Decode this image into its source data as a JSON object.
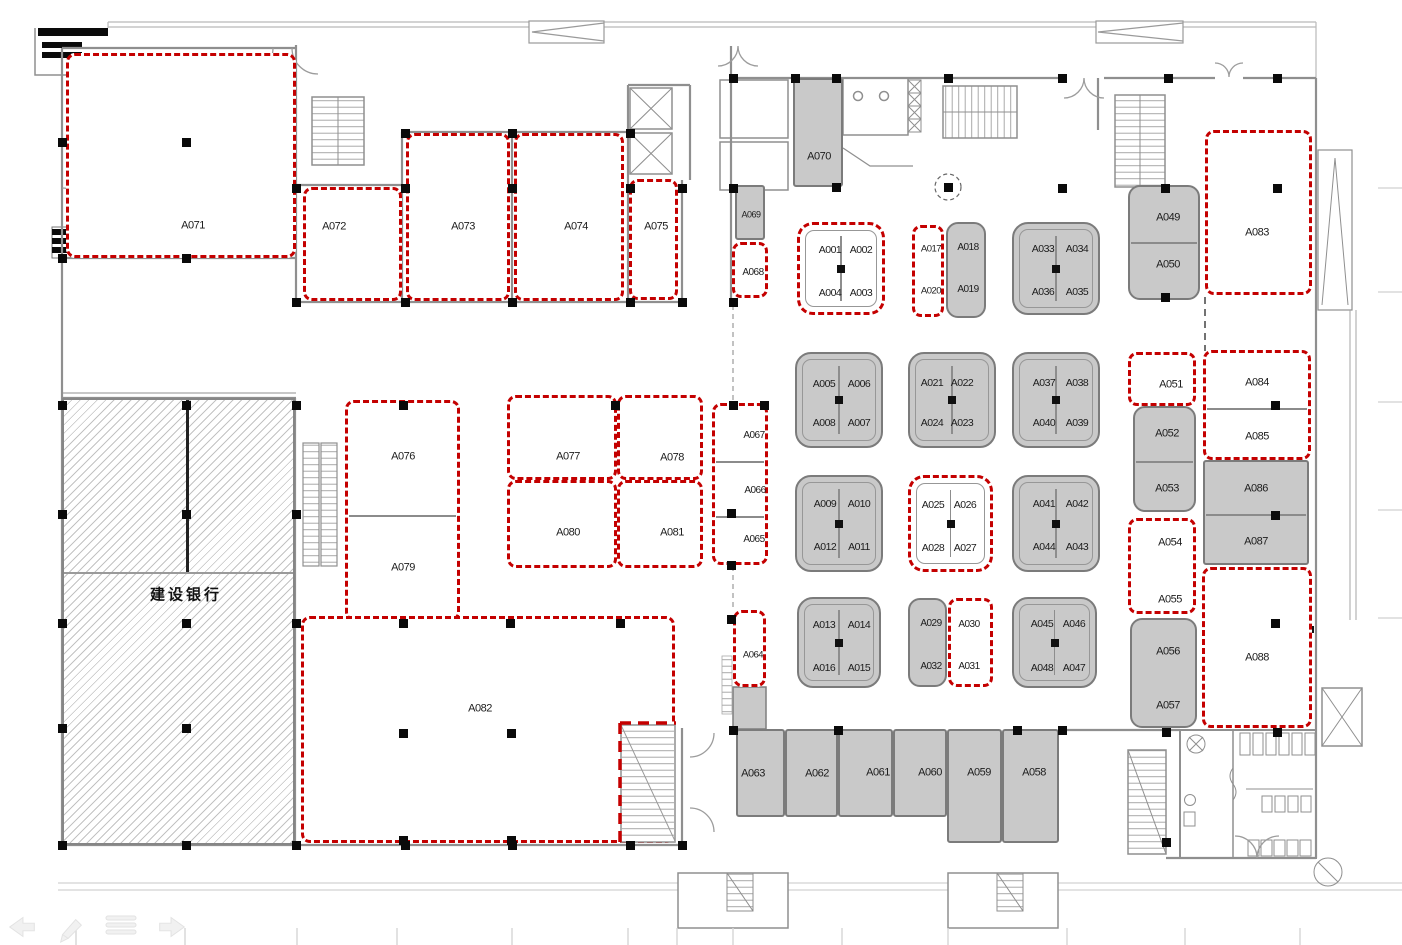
{
  "plan_title": "Mall floor plan with leasing unit numbers",
  "colors": {
    "accent_red": "#c40000",
    "unit_gray": "#c9c9c9",
    "wall_gray": "#8f8f8f",
    "hatch_gray": "#919191"
  },
  "bank": {
    "label": "建设银行"
  },
  "ghost_toolbar": {
    "icons": [
      {
        "name": "back-arrow-icon"
      },
      {
        "name": "pencil-icon"
      },
      {
        "name": "list-icon"
      },
      {
        "name": "forward-arrow-icon"
      }
    ]
  },
  "units": [
    {
      "s": "red",
      "x": 66,
      "y": 53,
      "w": 230,
      "h": 205,
      "l": [
        {
          "t": "A071",
          "cx": 190,
          "cy": 223
        }
      ]
    },
    {
      "s": "red",
      "x": 303,
      "y": 187,
      "w": 99,
      "h": 114,
      "l": [
        {
          "t": "A072",
          "cx": 331,
          "cy": 224
        }
      ]
    },
    {
      "s": "red",
      "x": 406,
      "y": 133,
      "w": 104,
      "h": 168,
      "l": [
        {
          "t": "A073",
          "cx": 460,
          "cy": 224
        }
      ]
    },
    {
      "s": "red",
      "x": 514,
      "y": 133,
      "w": 110,
      "h": 168,
      "l": [
        {
          "t": "A074",
          "cx": 573,
          "cy": 224
        }
      ]
    },
    {
      "s": "red",
      "x": 629,
      "y": 179,
      "w": 49,
      "h": 121,
      "l": [
        {
          "t": "A075",
          "cx": 653,
          "cy": 224
        }
      ]
    },
    {
      "s": "gray",
      "x": 793,
      "y": 78,
      "w": 50,
      "h": 109,
      "l": [
        {
          "t": "A070",
          "cx": 817,
          "cy": 155
        }
      ]
    },
    {
      "s": "gray",
      "x": 735,
      "y": 185,
      "w": 30,
      "h": 55,
      "fs": 9,
      "l": [
        {
          "t": "A069",
          "cx": 749,
          "cy": 213
        }
      ]
    },
    {
      "s": "red",
      "x": 732,
      "y": 242,
      "w": 36,
      "h": 56,
      "fs": 10,
      "l": [
        {
          "t": "A068",
          "cx": 750,
          "cy": 270
        }
      ]
    },
    {
      "s": "kioskred",
      "x": 797,
      "y": 222,
      "w": 88,
      "h": 93,
      "l": [
        {
          "t": "A001",
          "cx": 827,
          "cy": 247
        },
        {
          "t": "A002",
          "cx": 858,
          "cy": 247
        },
        {
          "t": "A004",
          "cx": 827,
          "cy": 290
        },
        {
          "t": "A003",
          "cx": 858,
          "cy": 290
        }
      ]
    },
    {
      "s": "red",
      "x": 912,
      "y": 225,
      "w": 32,
      "h": 92,
      "fs": 9.5,
      "l": [
        {
          "t": "A017",
          "cx": 928,
          "cy": 246
        },
        {
          "t": "A020",
          "cx": 928,
          "cy": 288
        }
      ]
    },
    {
      "s": "grayround",
      "x": 946,
      "y": 222,
      "w": 40,
      "h": 96,
      "fs": 10,
      "l": [
        {
          "t": "A018",
          "cx": 966,
          "cy": 246
        },
        {
          "t": "A019",
          "cx": 966,
          "cy": 288
        }
      ]
    },
    {
      "s": "kioskgray",
      "x": 1012,
      "y": 222,
      "w": 88,
      "h": 93,
      "l": [
        {
          "t": "A033",
          "cx": 1041,
          "cy": 247
        },
        {
          "t": "A034",
          "cx": 1075,
          "cy": 247
        },
        {
          "t": "A036",
          "cx": 1041,
          "cy": 290
        },
        {
          "t": "A035",
          "cx": 1075,
          "cy": 290
        }
      ]
    },
    {
      "s": "grayround",
      "x": 1128,
      "y": 185,
      "w": 72,
      "h": 115,
      "d": [
        240
      ],
      "l": [
        {
          "t": "A049",
          "cx": 1166,
          "cy": 216
        },
        {
          "t": "A050",
          "cx": 1166,
          "cy": 263
        }
      ]
    },
    {
      "s": "red",
      "x": 1205,
      "y": 130,
      "w": 107,
      "h": 165,
      "l": [
        {
          "t": "A083",
          "cx": 1254,
          "cy": 230
        }
      ]
    },
    {
      "s": "kioskgray",
      "x": 795,
      "y": 352,
      "w": 88,
      "h": 96,
      "l": [
        {
          "t": "A005",
          "cx": 822,
          "cy": 382
        },
        {
          "t": "A006",
          "cx": 857,
          "cy": 382
        },
        {
          "t": "A008",
          "cx": 822,
          "cy": 421
        },
        {
          "t": "A007",
          "cx": 857,
          "cy": 421
        }
      ]
    },
    {
      "s": "kioskgray",
      "x": 908,
      "y": 352,
      "w": 88,
      "h": 96,
      "l": [
        {
          "t": "A021",
          "cx": 930,
          "cy": 381
        },
        {
          "t": "A022",
          "cx": 960,
          "cy": 381
        },
        {
          "t": "A024",
          "cx": 930,
          "cy": 421
        },
        {
          "t": "A023",
          "cx": 960,
          "cy": 421
        }
      ]
    },
    {
      "s": "kioskgray",
      "x": 1012,
      "y": 352,
      "w": 88,
      "h": 96,
      "l": [
        {
          "t": "A037",
          "cx": 1042,
          "cy": 381
        },
        {
          "t": "A038",
          "cx": 1075,
          "cy": 381
        },
        {
          "t": "A040",
          "cx": 1042,
          "cy": 421
        },
        {
          "t": "A039",
          "cx": 1075,
          "cy": 421
        }
      ]
    },
    {
      "s": "kioskgray",
      "x": 795,
      "y": 475,
      "w": 88,
      "h": 97,
      "l": [
        {
          "t": "A009",
          "cx": 823,
          "cy": 502
        },
        {
          "t": "A010",
          "cx": 857,
          "cy": 502
        },
        {
          "t": "A012",
          "cx": 823,
          "cy": 545
        },
        {
          "t": "A011",
          "cx": 857,
          "cy": 545
        }
      ]
    },
    {
      "s": "kioskred",
      "x": 908,
      "y": 475,
      "w": 85,
      "h": 97,
      "l": [
        {
          "t": "A025",
          "cx": 930,
          "cy": 502
        },
        {
          "t": "A026",
          "cx": 962,
          "cy": 502
        },
        {
          "t": "A028",
          "cx": 930,
          "cy": 545
        },
        {
          "t": "A027",
          "cx": 962,
          "cy": 545
        }
      ]
    },
    {
      "s": "kioskgray",
      "x": 1012,
      "y": 475,
      "w": 88,
      "h": 97,
      "l": [
        {
          "t": "A041",
          "cx": 1042,
          "cy": 502
        },
        {
          "t": "A042",
          "cx": 1075,
          "cy": 502
        },
        {
          "t": "A044",
          "cx": 1042,
          "cy": 545
        },
        {
          "t": "A043",
          "cx": 1075,
          "cy": 545
        }
      ]
    },
    {
      "s": "kioskgray",
      "x": 797,
      "y": 597,
      "w": 84,
      "h": 91,
      "l": [
        {
          "t": "A013",
          "cx": 822,
          "cy": 623
        },
        {
          "t": "A014",
          "cx": 857,
          "cy": 623
        },
        {
          "t": "A016",
          "cx": 822,
          "cy": 666
        },
        {
          "t": "A015",
          "cx": 857,
          "cy": 666
        }
      ]
    },
    {
      "s": "grayround",
      "x": 908,
      "y": 598,
      "w": 39,
      "h": 89,
      "fs": 10,
      "l": [
        {
          "t": "A029",
          "cx": 929,
          "cy": 622
        },
        {
          "t": "A032",
          "cx": 929,
          "cy": 665
        }
      ]
    },
    {
      "s": "red",
      "x": 948,
      "y": 598,
      "w": 45,
      "h": 89,
      "fs": 10,
      "l": [
        {
          "t": "A030",
          "cx": 966,
          "cy": 622
        },
        {
          "t": "A031",
          "cx": 966,
          "cy": 664
        }
      ]
    },
    {
      "s": "kioskgray",
      "x": 1012,
      "y": 597,
      "w": 85,
      "h": 91,
      "l": [
        {
          "t": "A045",
          "cx": 1040,
          "cy": 622
        },
        {
          "t": "A046",
          "cx": 1072,
          "cy": 622
        },
        {
          "t": "A048",
          "cx": 1040,
          "cy": 666
        },
        {
          "t": "A047",
          "cx": 1072,
          "cy": 666
        }
      ]
    },
    {
      "s": "red",
      "x": 1128,
      "y": 352,
      "w": 68,
      "h": 54,
      "l": [
        {
          "t": "A051",
          "cx": 1168,
          "cy": 382
        }
      ]
    },
    {
      "s": "red",
      "x": 1203,
      "y": 350,
      "w": 108,
      "h": 110,
      "d": [
        405
      ],
      "l": [
        {
          "t": "A084",
          "cx": 1254,
          "cy": 380
        },
        {
          "t": "A085",
          "cx": 1254,
          "cy": 434
        }
      ]
    },
    {
      "s": "grayround",
      "x": 1133,
      "y": 406,
      "w": 63,
      "h": 106,
      "d": [
        459
      ],
      "l": [
        {
          "t": "A052",
          "cx": 1165,
          "cy": 432
        },
        {
          "t": "A053",
          "cx": 1165,
          "cy": 487
        }
      ]
    },
    {
      "s": "gray",
      "x": 1203,
      "y": 460,
      "w": 106,
      "h": 105,
      "d": [
        512
      ],
      "l": [
        {
          "t": "A086",
          "cx": 1254,
          "cy": 487
        },
        {
          "t": "A087",
          "cx": 1254,
          "cy": 540
        }
      ]
    },
    {
      "s": "red",
      "x": 1128,
      "y": 518,
      "w": 68,
      "h": 96,
      "l": [
        {
          "t": "A054",
          "cx": 1167,
          "cy": 540
        },
        {
          "t": "A055",
          "cx": 1167,
          "cy": 597
        }
      ]
    },
    {
      "s": "grayround",
      "x": 1130,
      "y": 618,
      "w": 67,
      "h": 110,
      "l": [
        {
          "t": "A056",
          "cx": 1166,
          "cy": 650
        },
        {
          "t": "A057",
          "cx": 1166,
          "cy": 704
        }
      ]
    },
    {
      "s": "red",
      "x": 1202,
      "y": 567,
      "w": 110,
      "h": 161,
      "l": [
        {
          "t": "A088",
          "cx": 1254,
          "cy": 655
        }
      ]
    },
    {
      "s": "red",
      "x": 712,
      "y": 403,
      "w": 56,
      "h": 162,
      "d": [
        458,
        513
      ],
      "fs": 10,
      "l": [
        {
          "t": "A067",
          "cx": 751,
          "cy": 433
        },
        {
          "t": "A066",
          "cx": 752,
          "cy": 488
        },
        {
          "t": "A065",
          "cx": 751,
          "cy": 537
        }
      ]
    },
    {
      "s": "red",
      "x": 733,
      "y": 610,
      "w": 33,
      "h": 77,
      "fs": 9.5,
      "l": [
        {
          "t": "A064",
          "cx": 750,
          "cy": 652
        }
      ]
    },
    {
      "s": "red",
      "x": 345,
      "y": 400,
      "w": 115,
      "h": 221,
      "d": [
        512
      ],
      "l": [
        {
          "t": "A076",
          "cx": 400,
          "cy": 454
        },
        {
          "t": "A079",
          "cx": 400,
          "cy": 565
        }
      ]
    },
    {
      "s": "red",
      "x": 507,
      "y": 395,
      "w": 110,
      "h": 85,
      "l": [
        {
          "t": "A077",
          "cx": 565,
          "cy": 454
        }
      ]
    },
    {
      "s": "red",
      "x": 617,
      "y": 395,
      "w": 86,
      "h": 85,
      "l": [
        {
          "t": "A078",
          "cx": 669,
          "cy": 455
        }
      ]
    },
    {
      "s": "red",
      "x": 507,
      "y": 480,
      "w": 110,
      "h": 88,
      "l": [
        {
          "t": "A080",
          "cx": 565,
          "cy": 530
        }
      ]
    },
    {
      "s": "red",
      "x": 617,
      "y": 480,
      "w": 86,
      "h": 88,
      "l": [
        {
          "t": "A081",
          "cx": 669,
          "cy": 530
        }
      ]
    },
    {
      "s": "red",
      "x": 301,
      "y": 616,
      "w": 374,
      "h": 227,
      "l": [
        {
          "t": "A082",
          "cx": 477,
          "cy": 706
        }
      ]
    },
    {
      "s": "gray",
      "x": 736,
      "y": 729,
      "w": 49,
      "h": 88,
      "l": [
        {
          "t": "A063",
          "cx": 751,
          "cy": 772
        }
      ]
    },
    {
      "s": "gray",
      "x": 785,
      "y": 729,
      "w": 53,
      "h": 88,
      "l": [
        {
          "t": "A062",
          "cx": 815,
          "cy": 772
        }
      ]
    },
    {
      "s": "gray",
      "x": 838,
      "y": 729,
      "w": 55,
      "h": 88,
      "l": [
        {
          "t": "A061",
          "cx": 876,
          "cy": 771
        }
      ]
    },
    {
      "s": "gray",
      "x": 893,
      "y": 729,
      "w": 54,
      "h": 88,
      "l": [
        {
          "t": "A060",
          "cx": 928,
          "cy": 771
        }
      ]
    },
    {
      "s": "gray",
      "x": 947,
      "y": 729,
      "w": 55,
      "h": 114,
      "l": [
        {
          "t": "A059",
          "cx": 977,
          "cy": 771
        }
      ]
    },
    {
      "s": "gray",
      "x": 1002,
      "y": 729,
      "w": 57,
      "h": 114,
      "l": [
        {
          "t": "A058",
          "cx": 1032,
          "cy": 771
        }
      ]
    }
  ],
  "columns": [
    [
      296,
      188
    ],
    [
      405,
      188
    ],
    [
      512,
      188
    ],
    [
      630,
      188
    ],
    [
      682,
      188
    ],
    [
      733,
      188
    ],
    [
      405,
      133
    ],
    [
      512,
      133
    ],
    [
      630,
      133
    ],
    [
      296,
      302
    ],
    [
      405,
      302
    ],
    [
      512,
      302
    ],
    [
      630,
      302
    ],
    [
      682,
      302
    ],
    [
      733,
      302
    ],
    [
      186,
      142
    ],
    [
      186,
      258
    ],
    [
      62,
      142
    ],
    [
      62,
      258
    ],
    [
      62,
      405
    ],
    [
      186,
      405
    ],
    [
      296,
      405
    ],
    [
      403,
      405
    ],
    [
      615,
      405
    ],
    [
      764,
      405
    ],
    [
      62,
      514
    ],
    [
      186,
      514
    ],
    [
      296,
      514
    ],
    [
      62,
      623
    ],
    [
      186,
      623
    ],
    [
      296,
      623
    ],
    [
      403,
      623
    ],
    [
      510,
      623
    ],
    [
      620,
      623
    ],
    [
      62,
      728
    ],
    [
      186,
      728
    ],
    [
      62,
      845
    ],
    [
      186,
      845
    ],
    [
      296,
      845
    ],
    [
      405,
      845
    ],
    [
      512,
      845
    ],
    [
      630,
      845
    ],
    [
      682,
      845
    ],
    [
      733,
      78
    ],
    [
      795,
      78
    ],
    [
      836,
      78
    ],
    [
      948,
      78
    ],
    [
      1062,
      78
    ],
    [
      1168,
      78
    ],
    [
      1277,
      78
    ],
    [
      836,
      187
    ],
    [
      1062,
      188
    ],
    [
      1165,
      188
    ],
    [
      1277,
      188
    ],
    [
      948,
      187
    ],
    [
      1165,
      297
    ],
    [
      733,
      405
    ],
    [
      731,
      513
    ],
    [
      731,
      565
    ],
    [
      731,
      619
    ],
    [
      1275,
      405
    ],
    [
      1275,
      515
    ],
    [
      1275,
      623
    ],
    [
      403,
      733
    ],
    [
      511,
      733
    ],
    [
      403,
      840
    ],
    [
      511,
      840
    ],
    [
      733,
      730
    ],
    [
      838,
      730
    ],
    [
      1017,
      730
    ],
    [
      1062,
      730
    ],
    [
      1166,
      732
    ],
    [
      1277,
      732
    ],
    [
      1166,
      842
    ]
  ]
}
